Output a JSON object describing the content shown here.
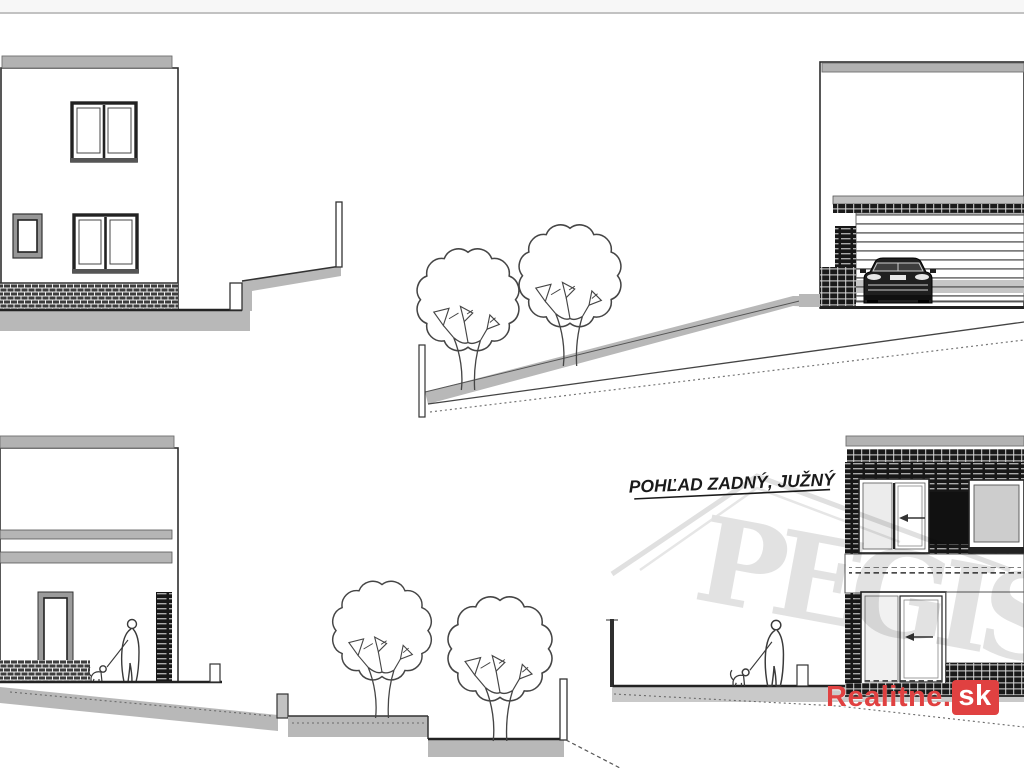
{
  "page": {
    "background": "#ffffff",
    "top_strip_color": "#f7f7f7",
    "line_color": "#2b2b2b",
    "terrain_color": "#b8b8b8",
    "roof_band_color": "#b2b2b2",
    "ground_strip_color": "#c9c9c9"
  },
  "drawing": {
    "title": "POHĽAD ZADNÝ, JUŽNÝ"
  },
  "figures": {
    "tree": "tree-icon",
    "person": "person-with-dog-icon",
    "car": "car-front-icon",
    "arrow": "slide-direction-arrow-icon"
  },
  "watermark": {
    "text": "PEGIS",
    "color": "#e2e2e2"
  },
  "logo": {
    "prefix": "Realitne.",
    "suffix": "sk",
    "red": "#e04141",
    "suffix_text_color": "#ffffff"
  }
}
